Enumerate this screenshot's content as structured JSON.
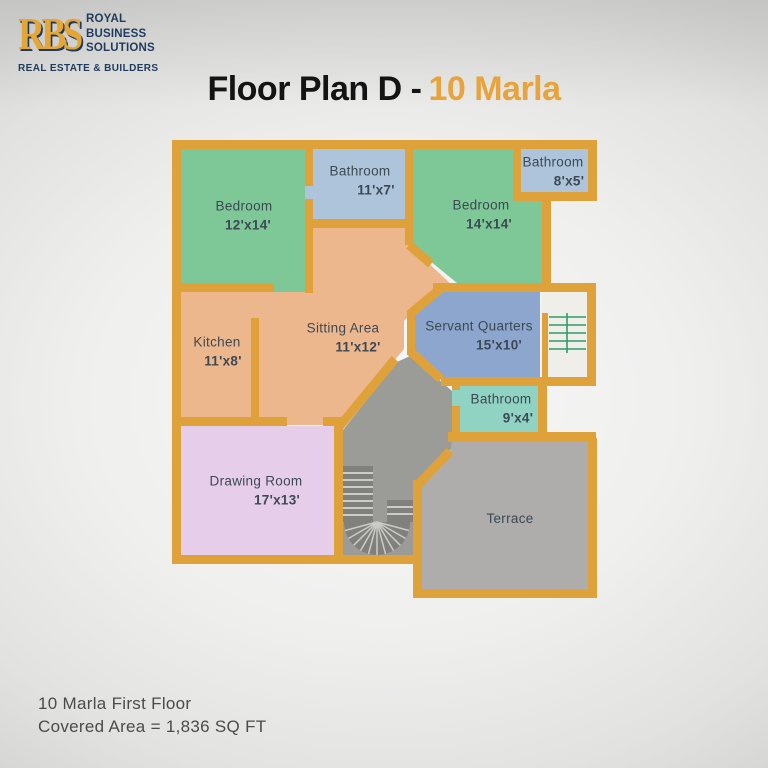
{
  "logo": {
    "monogram": "RBS",
    "name_lines": [
      "ROYAL",
      "BUSINESS",
      "SOLUTIONS"
    ],
    "tagline": "REAL ESTATE & BUILDERS"
  },
  "title": {
    "prefix": "Floor Plan D -",
    "highlight": "10 Marla"
  },
  "rooms": [
    {
      "id": "bedroom-1",
      "name": "Bedroom",
      "size": "12'x14'"
    },
    {
      "id": "bathroom-1",
      "name": "Bathroom",
      "size": "11'x7'"
    },
    {
      "id": "bedroom-2",
      "name": "Bedroom",
      "size": "14'x14'"
    },
    {
      "id": "bathroom-2",
      "name": "Bathroom",
      "size": "8'x5'"
    },
    {
      "id": "kitchen",
      "name": "Kitchen",
      "size": "11'x8'"
    },
    {
      "id": "sitting-area",
      "name": "Sitting Area",
      "size": "11'x12'"
    },
    {
      "id": "servant-quarters",
      "name": "Servant Quarters",
      "size": "15'x10'"
    },
    {
      "id": "bathroom-3",
      "name": "Bathroom",
      "size": "9'x4'"
    },
    {
      "id": "drawing-room",
      "name": "Drawing Room",
      "size": "17'x13'"
    },
    {
      "id": "terrace",
      "name": "Terrace",
      "size": ""
    }
  ],
  "footer": {
    "line1": "10 Marla First Floor",
    "line2": "Covered Area = 1,836 SQ FT"
  },
  "palette": {
    "wall": "#DFA23B",
    "bedroom": "#7EC897",
    "bathroom": "#AEC4DA",
    "living": "#EDB78E",
    "servant": "#8CA6CE",
    "bathroom_small": "#90D3C3",
    "drawing": "#E6CEEA",
    "stairs_gray": "#9B9B98",
    "terrace_gray": "#AEADAB",
    "stair_steps": "#80807D",
    "stair_hall": "#EFEEE9",
    "stair_hall_lines": "#2F9C6C",
    "label_text": "#3C4953",
    "title_accent": "#E8A43C",
    "logo_navy": "#1E3B5E",
    "logo_gold": "#E3A637"
  }
}
